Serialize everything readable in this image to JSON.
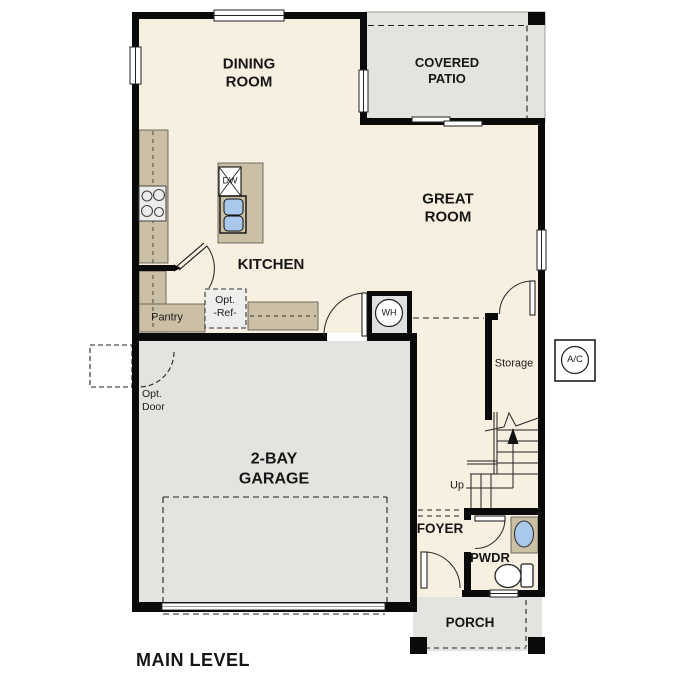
{
  "plan_title": "MAIN LEVEL",
  "rooms": {
    "dining": {
      "line1": "DINING",
      "line2": "ROOM"
    },
    "covered_patio": {
      "line1": "COVERED",
      "line2": "PATIO"
    },
    "great": {
      "line1": "GREAT",
      "line2": "ROOM"
    },
    "kitchen": {
      "label": "KITCHEN"
    },
    "garage": {
      "line1": "2-BAY",
      "line2": "GARAGE"
    },
    "foyer": {
      "label": "FOYER"
    },
    "pwdr": {
      "label": "PWDR"
    },
    "porch": {
      "label": "PORCH"
    },
    "pantry": {
      "label": "Pantry"
    },
    "storage": {
      "label": "Storage"
    }
  },
  "annotations": {
    "up": "Up",
    "opt_door": {
      "line1": "Opt.",
      "line2": "Door"
    },
    "opt_ref": {
      "line1": "Opt.",
      "line2": "-Ref-"
    }
  },
  "fixtures": {
    "water_heater": "WH",
    "ac_unit": "A/C",
    "dishwasher": "DW"
  },
  "colors": {
    "floor": "#f7efe0",
    "outdoor": "#e3e3e0",
    "casework": "#cbbfa5",
    "wall": "#0a0a0a",
    "sink_blue": "#a9c9ec"
  }
}
